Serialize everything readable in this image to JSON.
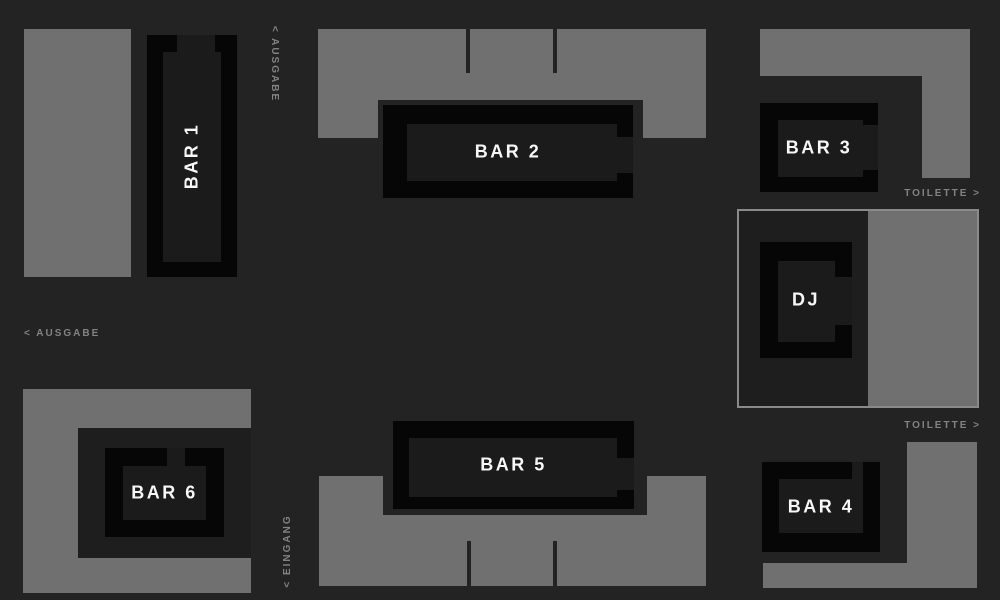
{
  "palette": {
    "background": "#232323",
    "floor_gray": "#707070",
    "bar_black": "#060606",
    "bar_inner": "#1b1b1b",
    "room_dark": "#1e1e1e",
    "dj_zone_border": "#8a8a8a",
    "sign_gray": "#828282",
    "label_white": "#f7f7f7"
  },
  "bars": {
    "bar1": {
      "label": "BAR 1"
    },
    "bar2": {
      "label": "BAR 2"
    },
    "bar3": {
      "label": "BAR 3"
    },
    "bar4": {
      "label": "BAR 4"
    },
    "bar5": {
      "label": "BAR 5"
    },
    "bar6": {
      "label": "BAR 6"
    },
    "dj": {
      "label": "DJ"
    }
  },
  "signs": {
    "ausgabe_top": "< AUSGABE",
    "ausgabe_left": "< AUSGABE",
    "eingang": "< EINGANG",
    "toilette_top": "TOILETTE >",
    "toilette_bottom": "TOILETTE >"
  }
}
